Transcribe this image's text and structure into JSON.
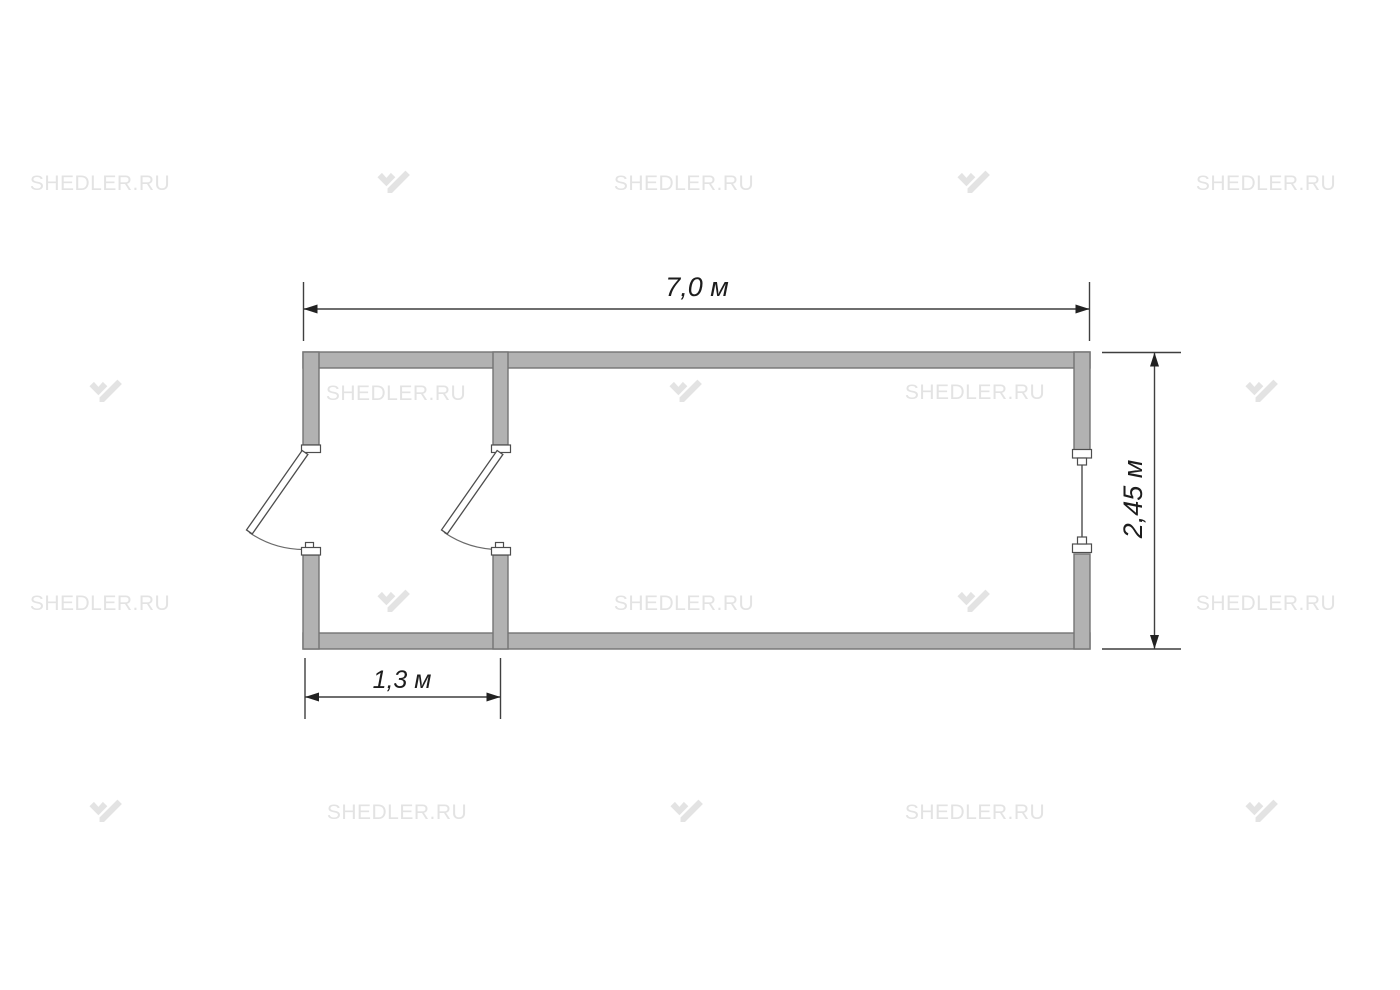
{
  "page": {
    "background_color": "#ffffff",
    "kind": "floor plan drawing"
  },
  "watermark": {
    "text": "SHEDLER.RU",
    "logo_icon": "shedler-logo",
    "color": "#e3e3e3"
  },
  "floor_plan": {
    "type": "container cabin plan, 2 rooms",
    "unit": "м",
    "dimensions": {
      "overall_length": "7,0 м",
      "overall_width": "2,45 м",
      "entry_room_width": "1,3 м"
    },
    "features": {
      "rooms_count": 2,
      "doors": [
        "exterior door in left end wall, swings outward",
        "interior door in partition wall, swings into entry room"
      ],
      "windows": [
        "window in right end wall"
      ]
    },
    "colors": {
      "wall_fill": "#b2b2b2",
      "wall_outline": "#747474",
      "door_fill": "#ffffff",
      "door_outline": "#4d4d4d",
      "dimension_line": "#3f3f3f",
      "dimension_text": "#1d1d1d"
    }
  }
}
